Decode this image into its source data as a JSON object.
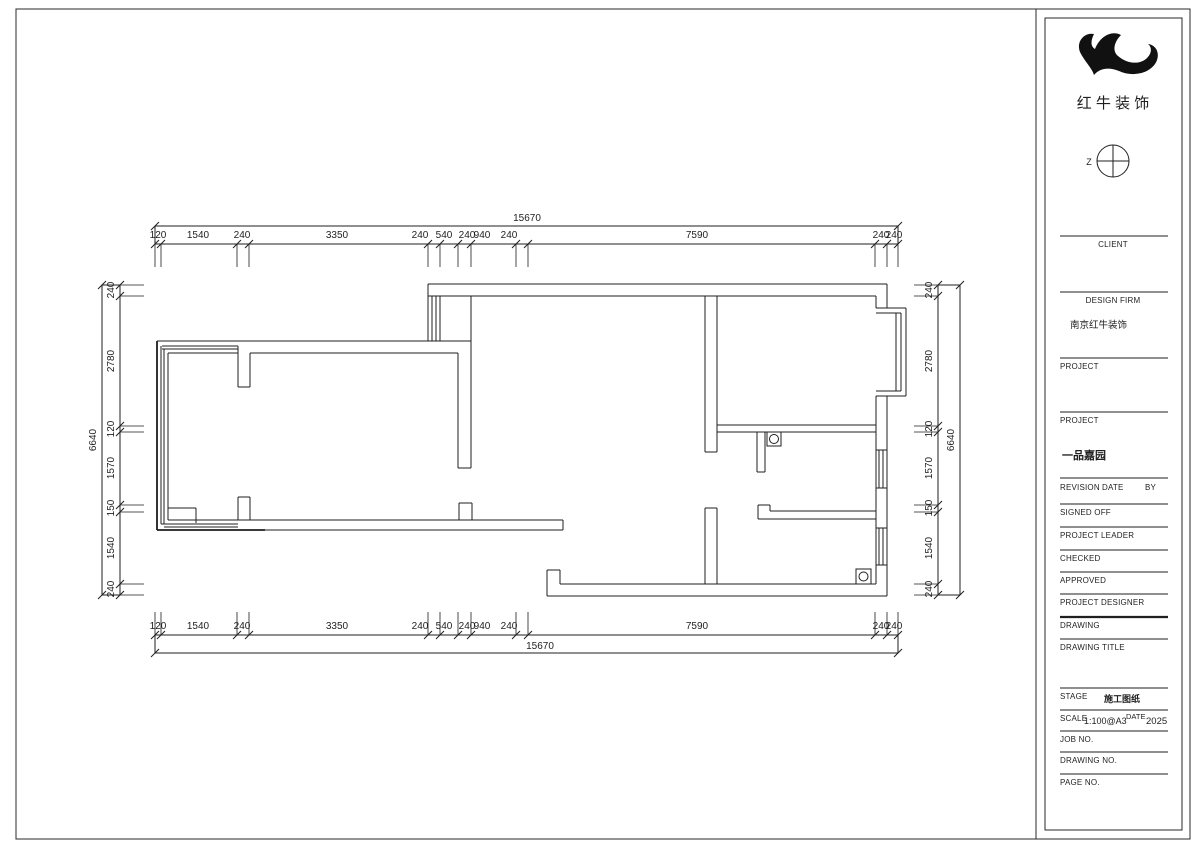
{
  "sheet": {
    "logo_text": "红 牛 装 饰",
    "north_label": "Z"
  },
  "title_block": {
    "client_label": "CLIENT",
    "design_firm_label": "DESIGN FIRM",
    "design_firm_value": "南京红牛装饰",
    "project_label_1": "PROJECT",
    "project_label_2": "PROJECT",
    "project_value": "一品嘉园",
    "revision_label": "REVISION",
    "date_label": "DATE",
    "by_label": "BY",
    "signed_off_label": "SIGNED OFF",
    "project_leader_label": "PROJECT LEADER",
    "checked_label": "CHECKED",
    "approved_label": "APPROVED",
    "project_designer_label": "PROJECT DESIGNER",
    "drawing_label": "DRAWING",
    "drawing_title_label": "DRAWING TITLE",
    "stage_label": "STAGE",
    "stage_value": "施工图纸",
    "scale_label": "SCALE",
    "scale_value": "1:100@A3",
    "scale_date_label": "DATE",
    "scale_date_value": "2025",
    "job_no_label": "JOB NO.",
    "drawing_no_label": "DRAWING NO.",
    "page_no_label": "PAGE NO."
  },
  "dims": {
    "horizontal": {
      "overall": "15670",
      "segments": [
        "120",
        "1540",
        "240",
        "3350",
        "240",
        "540",
        "240",
        "940",
        "240",
        "7590",
        "240",
        "240"
      ]
    },
    "vertical": {
      "overall": "6640",
      "segments": [
        "240",
        "2780",
        "120",
        "1570",
        "150",
        "1540",
        "240"
      ]
    }
  }
}
